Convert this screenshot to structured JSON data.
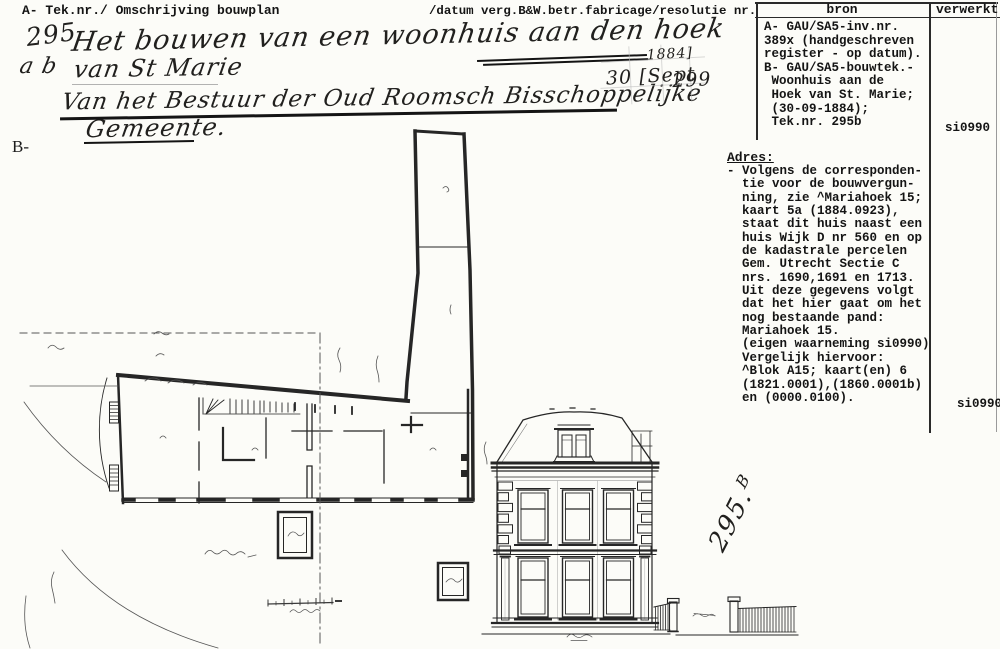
{
  "colors": {
    "paper": "#fcfcf8",
    "ink": "#161616",
    "faint_line": "#b9b9b9"
  },
  "header": {
    "left": "A- Tek.nr./ Omschrijving bouwplan",
    "right": "/datum verg.B&W.betr.fabricage/resolutie nr."
  },
  "handwriting": {
    "number": "295",
    "line1": "Het bouwen van een woonhuis aan den hoek",
    "prefix2": "a b",
    "line2": "van St Marie",
    "line3": "Van het Bestuur der Oud Roomsch Bisschoppelijke",
    "line4": "Gemeente."
  },
  "stamp": {
    "year": "1884]",
    "date": "30 [Sept",
    "number": "299"
  },
  "section_b_label": "B-",
  "table": {
    "bron_header": "bron",
    "verwerkt_header": "verwerkt",
    "bron_lines": [
      "A- GAU/SA5-inv.nr.",
      "389x (handgeschreven",
      "register - op datum).",
      "B- GAU/SA5-bouwtek.-",
      " Woonhuis aan de",
      " Hoek van St. Marie;",
      " (30-09-1884);",
      " Tek.nr. 295b"
    ],
    "verwerkt_value_1": "si0990",
    "verwerkt_value_2": "si0990"
  },
  "adres": {
    "title": "Adres:",
    "lines": [
      "- Volgens de corresponden-",
      "  tie voor de bouwvergun-",
      "  ning, zie ^Mariahoek 15;",
      "  kaart 5a (1884.0923),",
      "  staat dit huis naast een",
      "  huis Wijk D nr 560 en op",
      "  de kadastrale percelen",
      "  Gem. Utrecht Sectie C",
      "  nrs. 1690,1691 en 1713.",
      "  Uit deze gegevens volgt",
      "  dat het hier gaat om het",
      "  nog bestaande pand:",
      "  Mariahoek 15.",
      "  (eigen waarneming si0990)",
      "  Vergelijk hiervoor:",
      "  ^Blok A15; kaart(en) 6",
      "  (1821.0001),(1860.0001b)",
      "  en (0000.0100)."
    ]
  },
  "drawing": {
    "plan_number": {
      "main": "295.",
      "sup": "B"
    }
  }
}
